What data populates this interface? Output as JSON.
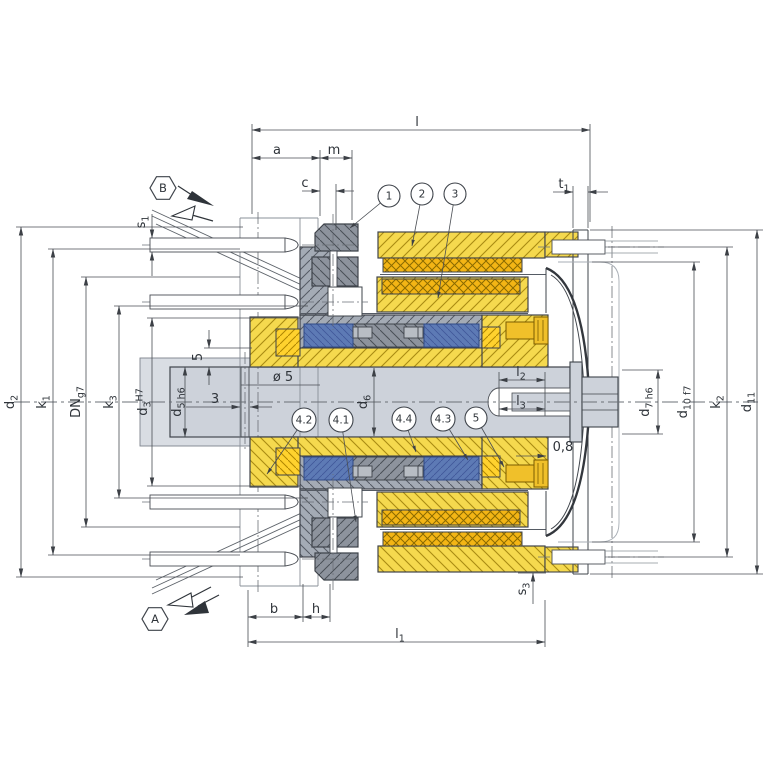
{
  "drawing": {
    "description": "Sectional technical drawing of an electromagnetic clutch with dimension symbols, part callouts and view direction markers A and B",
    "colors": {
      "part_yellow": "#f5d94e",
      "coil_gold": "#f3b515",
      "bright_gold": "#ffd22e",
      "part_blue": "#5d7ab5",
      "part_gray": "#9ba2ac",
      "part_darkgray": "#8d939d",
      "shaft_gray": "#cdd2da",
      "outline": "#3f444b",
      "dim_line": "#4a4e54"
    },
    "view_markers": [
      {
        "label": "B",
        "cx": 163,
        "cy": 188,
        "r": 13
      },
      {
        "label": "A",
        "cx": 155,
        "cy": 619,
        "r": 13
      }
    ],
    "part_callouts": [
      {
        "label": "1",
        "cx": 389,
        "cy": 196,
        "tx": 350,
        "ty": 228
      },
      {
        "label": "2",
        "cx": 422,
        "cy": 194,
        "tx": 412,
        "ty": 246
      },
      {
        "label": "3",
        "cx": 455,
        "cy": 194,
        "tx": 438,
        "ty": 298
      },
      {
        "label": "4.2",
        "cx": 304,
        "cy": 420,
        "tx": 267,
        "ty": 474
      },
      {
        "label": "4.1",
        "cx": 341,
        "cy": 420,
        "tx": 356,
        "ty": 522
      },
      {
        "label": "4.4",
        "cx": 404,
        "cy": 419,
        "tx": 416,
        "ty": 452
      },
      {
        "label": "4.3",
        "cx": 443,
        "cy": 419,
        "tx": 468,
        "ty": 460
      },
      {
        "label": "5",
        "cx": 476,
        "cy": 418,
        "tx": 504,
        "ty": 467
      }
    ],
    "dim_labels": [
      {
        "t": "l",
        "x": 417,
        "y": 126
      },
      {
        "t": "a",
        "x": 277,
        "y": 154
      },
      {
        "t": "m",
        "x": 334,
        "y": 154
      },
      {
        "t": "c",
        "x": 305,
        "y": 187
      },
      {
        "t": "t_{1}",
        "x": 564,
        "y": 188
      },
      {
        "t": "s_{1}",
        "x": 145,
        "y": 222,
        "r": 1
      },
      {
        "t": "d_{2}",
        "x": 14,
        "y": 402,
        "r": 1
      },
      {
        "t": "k_{1}",
        "x": 46,
        "y": 402,
        "r": 1
      },
      {
        "t": "DN_{g7}",
        "x": 80,
        "y": 402,
        "r": 1
      },
      {
        "t": "k_{3}",
        "x": 113,
        "y": 402,
        "r": 1
      },
      {
        "t": "d_{3}^{H7}",
        "x": 147,
        "y": 402,
        "r": 1
      },
      {
        "t": "d_{5 h6}",
        "x": 181,
        "y": 402,
        "r": 1
      },
      {
        "t": "5",
        "x": 202,
        "y": 357,
        "r": 1
      },
      {
        "t": "3",
        "x": 215,
        "y": 403
      },
      {
        "t": "ø 5",
        "x": 283,
        "y": 381
      },
      {
        "t": "d_{6}",
        "x": 367,
        "y": 402,
        "r": 1
      },
      {
        "t": "l_{2}",
        "x": 521,
        "y": 376
      },
      {
        "t": "l_{3}",
        "x": 521,
        "y": 405
      },
      {
        "t": "0,8",
        "x": 563,
        "y": 451
      },
      {
        "t": "d_{7 h6}",
        "x": 649,
        "y": 402,
        "r": 1
      },
      {
        "t": "d_{10 f7}",
        "x": 687,
        "y": 402,
        "r": 1
      },
      {
        "t": "k_{2}",
        "x": 720,
        "y": 402,
        "r": 1
      },
      {
        "t": "d_{11}",
        "x": 751,
        "y": 402,
        "r": 1
      },
      {
        "t": "b",
        "x": 274,
        "y": 613
      },
      {
        "t": "h",
        "x": 316,
        "y": 613
      },
      {
        "t": "l_{1}",
        "x": 400,
        "y": 638
      },
      {
        "t": "s_{3}",
        "x": 526,
        "y": 589,
        "r": 1
      }
    ]
  }
}
